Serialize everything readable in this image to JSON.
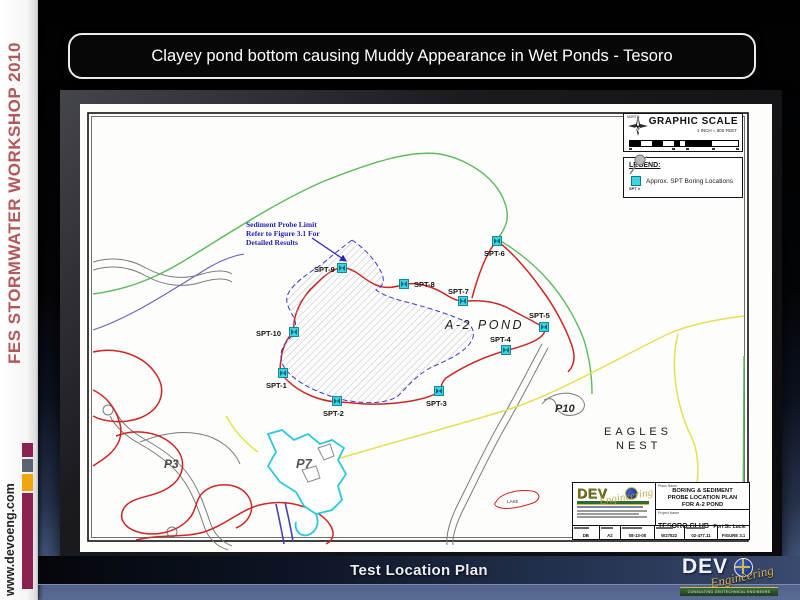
{
  "slide": {
    "title": "Clayey pond bottom causing Muddy Appearance in Wet Ponds - Tesoro",
    "footer": "Test Location Plan"
  },
  "sidebar": {
    "workshop": "FES STORMWATER WORKSHOP 2010",
    "website": "www.devoeng.com",
    "accent_red": "#b25858",
    "maroon": "#8c2150",
    "slate": "#5c6472",
    "amber": "#f2a50c"
  },
  "map": {
    "scale": {
      "north": "NORTH",
      "title": "GRAPHIC SCALE",
      "ratio": "1 INCH = 800 FEET"
    },
    "legend": {
      "title": "LEGEND:",
      "symbol_label": "SPT #",
      "entry": "Approx. SPT Boring Locations"
    },
    "note": {
      "l1": "Sediment Probe Limit",
      "l2": "Refer to Figure 3.1 For",
      "l3": "Detailed Results"
    },
    "labels": {
      "pond": "A-2 POND",
      "eagles1": "EAGLES",
      "eagles2": "NEST",
      "p3": "P3",
      "p7": "P7",
      "p10": "P10",
      "lake": "LAKE"
    },
    "borings": [
      {
        "id": "SPT-1",
        "mx": 203,
        "my": 269,
        "lx": 186,
        "ly": 284
      },
      {
        "id": "SPT-2",
        "mx": 257,
        "my": 297,
        "lx": 243,
        "ly": 312
      },
      {
        "id": "SPT-3",
        "mx": 359,
        "my": 287,
        "lx": 346,
        "ly": 302
      },
      {
        "id": "SPT-4",
        "mx": 426,
        "my": 246,
        "lx": 410,
        "ly": 238
      },
      {
        "id": "SPT-5",
        "mx": 464,
        "my": 223,
        "lx": 449,
        "ly": 214
      },
      {
        "id": "SPT-6",
        "mx": 417,
        "my": 137,
        "lx": 404,
        "ly": 152
      },
      {
        "id": "SPT-7",
        "mx": 383,
        "my": 197,
        "lx": 368,
        "ly": 190
      },
      {
        "id": "SPT-8",
        "mx": 324,
        "my": 180,
        "lx": 334,
        "ly": 183
      },
      {
        "id": "SPT-9",
        "mx": 262,
        "my": 164,
        "lx": 234,
        "ly": 168
      },
      {
        "id": "SPT-10",
        "mx": 214,
        "my": 228,
        "lx": 176,
        "ly": 232
      }
    ],
    "title_block": {
      "logo": "DEV",
      "logo_script": "Engineering",
      "plans_label": "Plans Name",
      "plan1": "BORING & SEDIMENT",
      "plan2": "PROBE LOCATION PLAN",
      "plan3": "FOR A-2 POND",
      "project_label": "Project Name",
      "project": "TESORO CLUB",
      "location": "Port St. Lucie",
      "cells": [
        {
          "v": "DB"
        },
        {
          "v": "A2"
        },
        {
          "v": "08-13-08"
        },
        {
          "v": "W27522"
        },
        {
          "v": "02-477.11"
        },
        {
          "v": "FIGURE 3.1"
        }
      ]
    },
    "line_colors": {
      "contour_red": "#cc2626",
      "boundary_green": "#5cbb5c",
      "contour_yellow": "#e6df55",
      "water_cyan": "#2cc8dc",
      "probe_blue": "#3a3ac8",
      "road_gray": "#7a7a7a"
    }
  },
  "footer_logo": {
    "dev": "DEV",
    "script": "Engineering",
    "tagline": "CONSULTING GEOTECHNICAL ENGINEERS"
  }
}
